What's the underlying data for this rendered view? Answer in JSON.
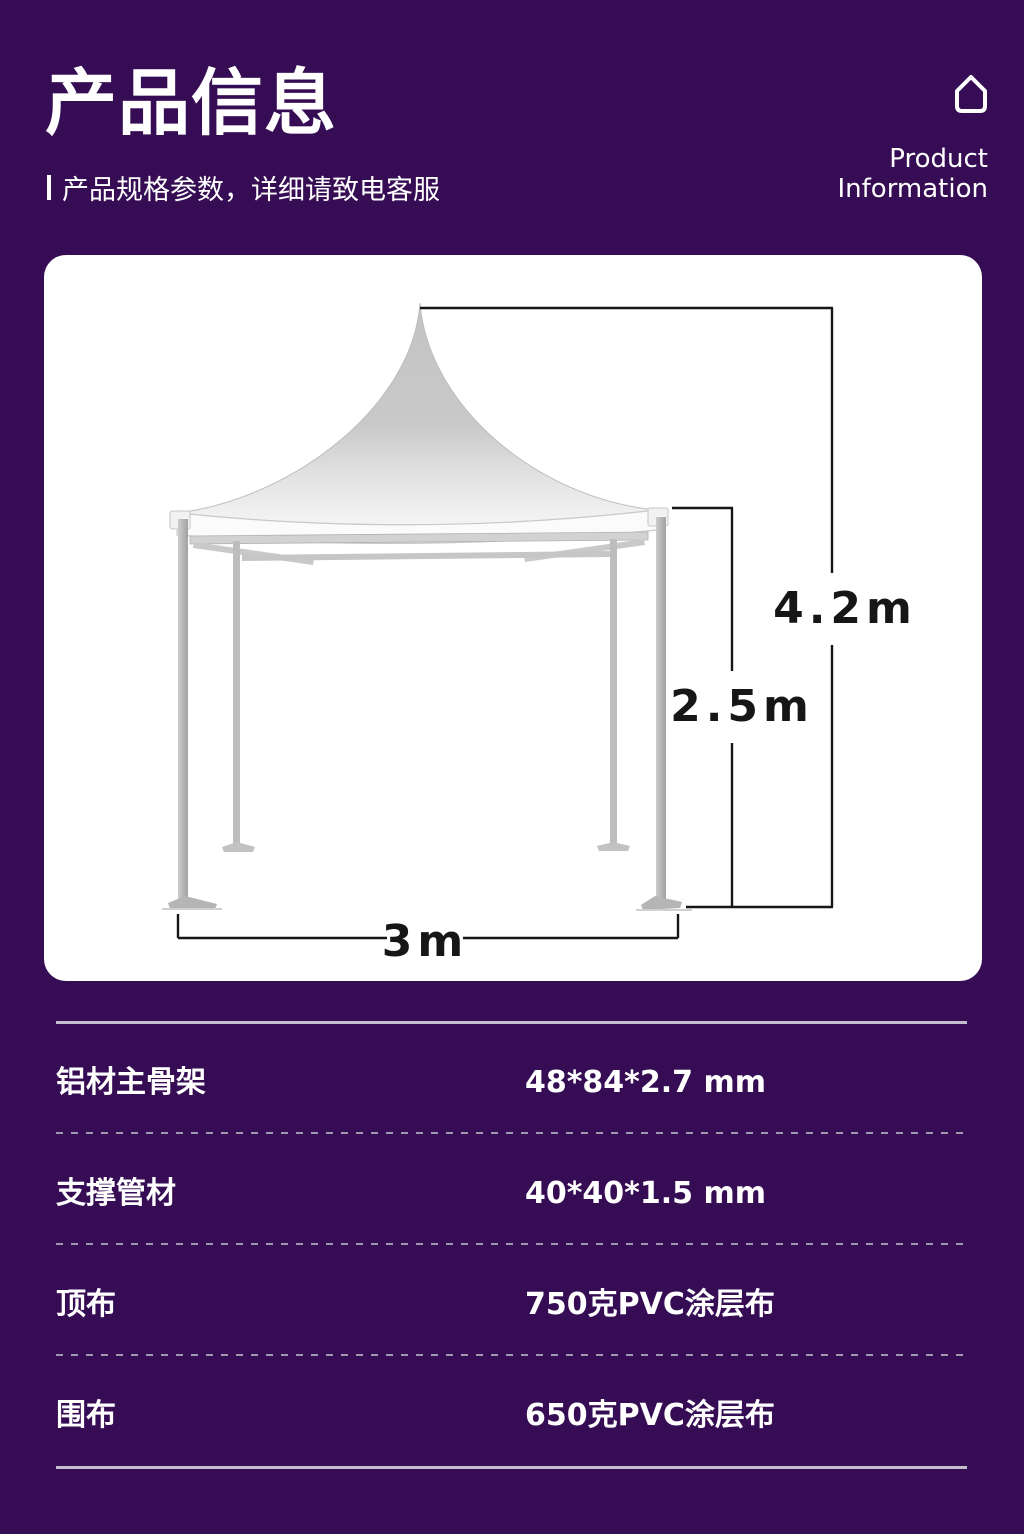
{
  "header": {
    "title": "产品信息",
    "subtitle": "产品规格参数，详细请致电客服",
    "right_line1": "Product",
    "right_line2": "Information"
  },
  "diagram": {
    "total_height": "4.2m",
    "leg_height": "2.5m",
    "width": "3m"
  },
  "specs": {
    "rows": [
      {
        "label": "铝材主骨架",
        "value": "48*84*2.7 mm"
      },
      {
        "label": "支撑管材",
        "value": "40*40*1.5 mm"
      },
      {
        "label": "顶布",
        "value": "750克PVC涂层布"
      },
      {
        "label": "围布",
        "value": "650克PVC涂层布"
      }
    ]
  },
  "colors": {
    "background": "#360D54",
    "card": "#FFFFFF",
    "text": "#FFFFFF",
    "dimension_line": "#161616",
    "rule": "#C4BECE",
    "dotted_rule": "#A098B0"
  }
}
